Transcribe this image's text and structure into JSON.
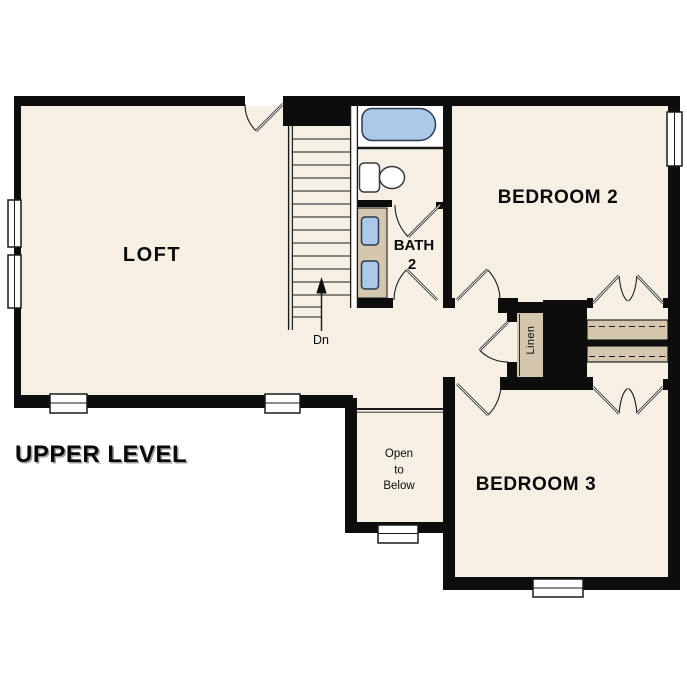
{
  "title": "UPPER LEVEL",
  "rooms": {
    "loft": "LOFT",
    "bedroom2": "BEDROOM 2",
    "bedroom3": "BEDROOM 3",
    "bath": "BATH",
    "bath_number": "2",
    "linen": "Linen"
  },
  "annotations": {
    "stair_direction": "Dn",
    "open_to_below": [
      "Open",
      "to",
      "Below"
    ]
  },
  "colors": {
    "wall": "#0d0d0d",
    "floor": "#f5efe4",
    "fixture_blue": "#aac8e8",
    "counter_tan": "#d5c6ae",
    "line": "#1a1a1a",
    "background": "#ffffff"
  }
}
